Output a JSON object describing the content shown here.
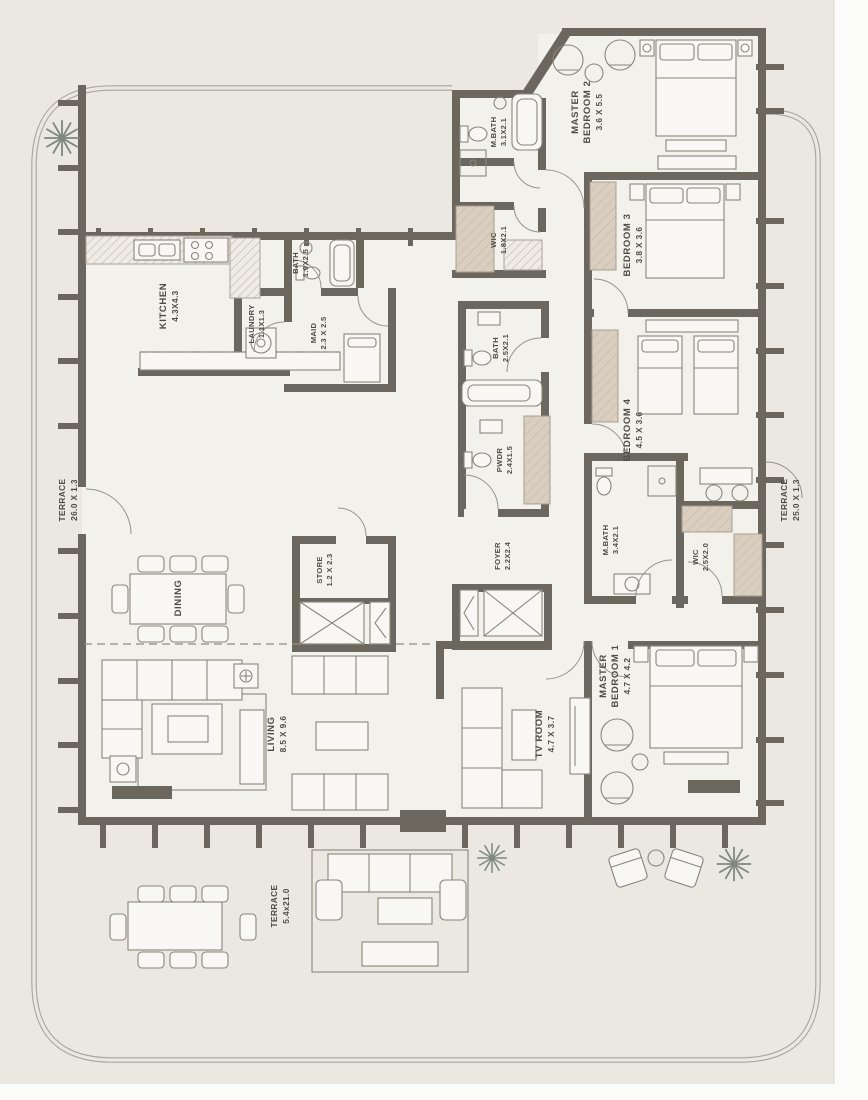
{
  "plan": {
    "rooms": {
      "terrace_left": {
        "lines": [
          "TERRACE"
        ],
        "dims": "26.0 X 1.3"
      },
      "terrace_right": {
        "lines": [
          "TERRACE"
        ],
        "dims": "25.0 X 1.3"
      },
      "terrace_bottom": {
        "lines": [
          "TERRACE"
        ],
        "dims": "5.4x21.0"
      },
      "kitchen": {
        "lines": [
          "KITCHEN"
        ],
        "dims": "4.3X4.3"
      },
      "laundry": {
        "lines": [
          "LAUNDRY"
        ],
        "dims": "1.1X1.3"
      },
      "bath_top": {
        "lines": [
          "BATH"
        ],
        "dims": "1.9X2.5"
      },
      "maid": {
        "lines": [
          "MAID"
        ],
        "dims": "2.3 X 2.5"
      },
      "master_bath_2": {
        "lines": [
          "M.BATH"
        ],
        "dims": "3.1X2.1"
      },
      "wic_2": {
        "lines": [
          "WIC"
        ],
        "dims": "1.8X2.1"
      },
      "master_bedroom_2": {
        "lines": [
          "MASTER",
          "BEDROOM 2"
        ],
        "dims": "3.6 X 5.5"
      },
      "bedroom_3": {
        "lines": [
          "BEDROOM 3"
        ],
        "dims": "3.8 X 3.6"
      },
      "bedroom_4": {
        "lines": [
          "BEDROOM 4"
        ],
        "dims": "4.5 X 3.6"
      },
      "bath_mid": {
        "lines": [
          "BATH"
        ],
        "dims": "2.5X2.1"
      },
      "powder": {
        "lines": [
          "PWDR"
        ],
        "dims": "2.4X1.5"
      },
      "foyer": {
        "lines": [
          "FOYER"
        ],
        "dims": "2.2X2.4"
      },
      "store": {
        "lines": [
          "STORE"
        ],
        "dims": "1.2 X 2.3"
      },
      "dining": {
        "lines": [
          "DINING"
        ],
        "dims": ""
      },
      "living": {
        "lines": [
          "LIVING"
        ],
        "dims": "8.5 X 9.6"
      },
      "tv_room": {
        "lines": [
          "TV ROOM"
        ],
        "dims": "4.7 X 3.7"
      },
      "master_bath_1": {
        "lines": [
          "M.BATH"
        ],
        "dims": "3.4X2.1"
      },
      "wic_1": {
        "lines": [
          "WIC"
        ],
        "dims": "2.5X2.0"
      },
      "master_bedroom_1": {
        "lines": [
          "MASTER",
          "BEDROOM 1"
        ],
        "dims": "4.7 X 4.2"
      }
    }
  }
}
